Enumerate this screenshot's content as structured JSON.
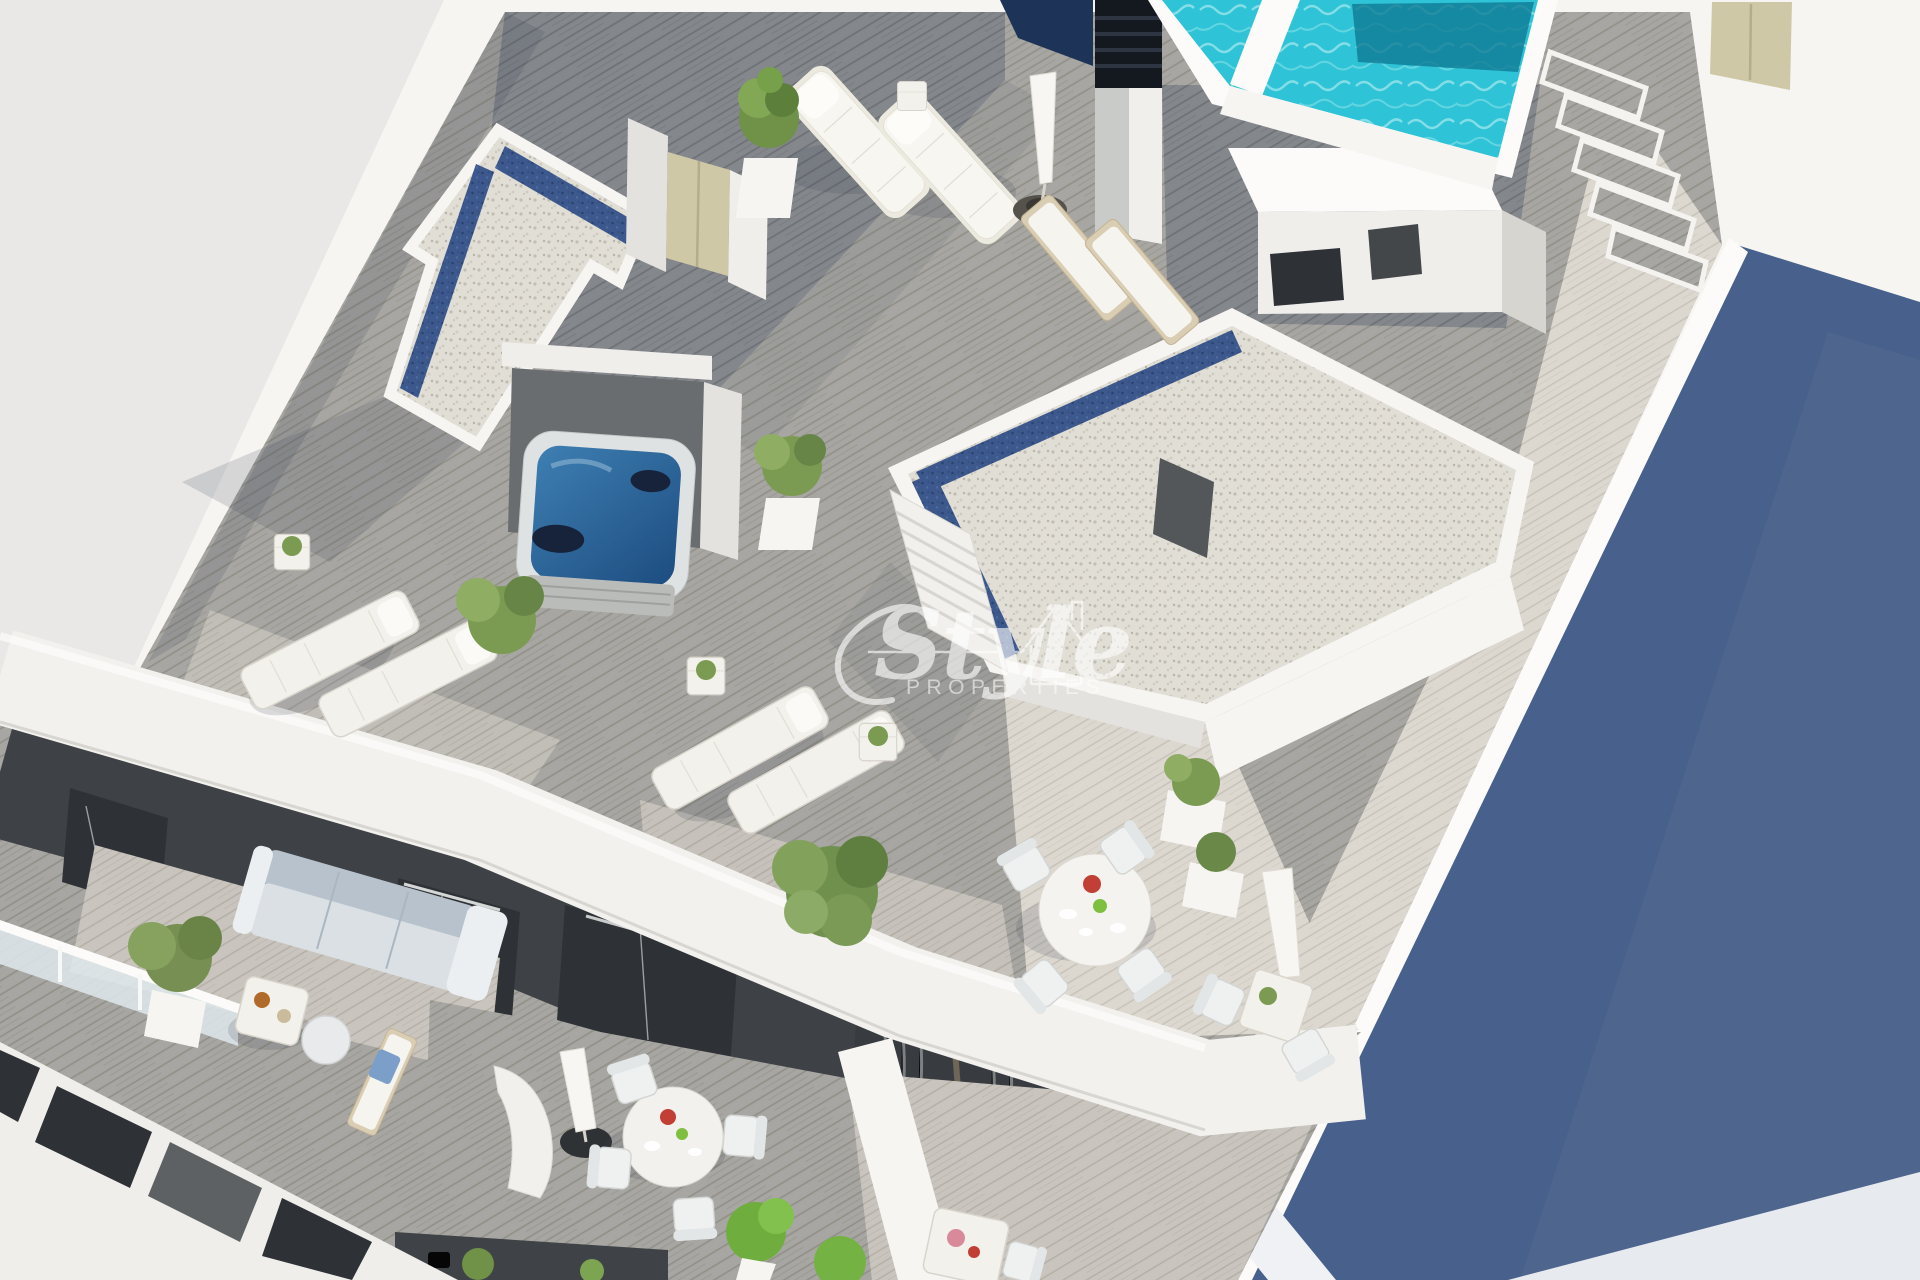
{
  "image": {
    "type": "3d-architectural-render",
    "view": "aerial-isometric",
    "subject": "Penthouse rooftop terraces of a modern white apartment building with pool, jacuzzi and lounge furniture"
  },
  "watermark": {
    "brand": "Style",
    "tagline": "PROPERTIES",
    "icon": "house-outline-icon",
    "color": "#ffffff"
  },
  "palette": {
    "background": "#e9e8e6",
    "wall_sunlit": "#f6f5f2",
    "wall_shaded": "#e4e2de",
    "deck_dark": "#7e8083",
    "deck_mid": "#a6a5a1",
    "deck_light": "#c9c5be",
    "deck_pale": "#dbd7cf",
    "pool_water": "#2ec3d6",
    "pool_water_deep": "#0e7a94",
    "jacuzzi_water": "#2a6095",
    "gravel": "#e1ded6",
    "pebble_blue": "#3c588c",
    "shadow_face_blue": "#47618c",
    "facade_dark": "#3e4145",
    "door_beige": "#cfc8a6",
    "sofa_blue": "#b7c2cd",
    "plant_green": "#7c9b52",
    "accent_red": "#c23f36",
    "accent_lime": "#7fbf3f"
  },
  "scene": {
    "rooftop_items": [
      "swimming-pool",
      "pool-steps",
      "chimney-vent",
      "stair-bulkhead",
      "gravel-roof-skylights",
      "jacuzzi",
      "sun-loungers",
      "side-tables",
      "parasols",
      "dining-set-round",
      "bistro-set",
      "potted-plants",
      "louvered-shutter-doors",
      "timber-deck"
    ],
    "lower_floor_items": [
      "corner-sofa",
      "coffee-table",
      "pouf",
      "timber-lounger",
      "glass-balustrade",
      "round-dining-table",
      "privacy-screen",
      "curtained-glass-doors",
      "window-slits",
      "planter-bushes"
    ]
  }
}
